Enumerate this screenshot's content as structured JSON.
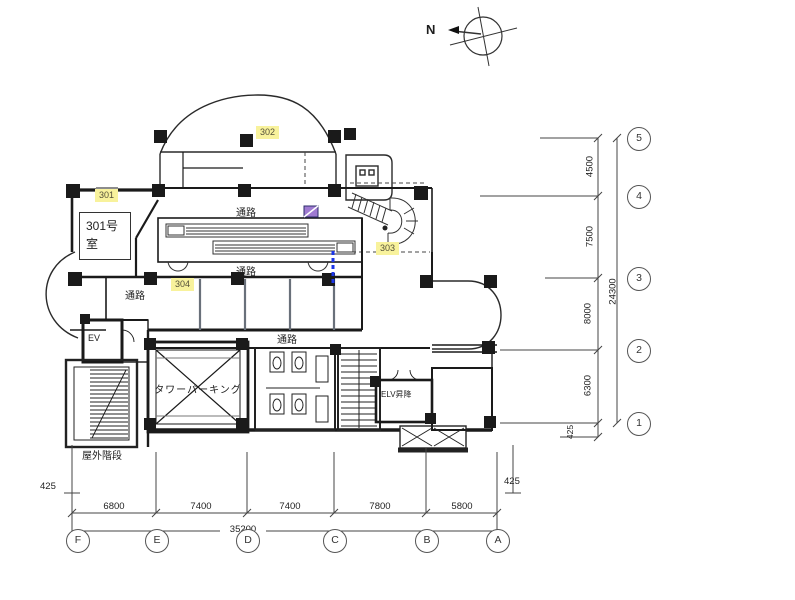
{
  "compass": {
    "north_label": "N"
  },
  "rooms": {
    "room301_label": "301号室",
    "badge301": "301",
    "badge302": "302",
    "badge303": "303",
    "badge304": "304",
    "passage": "通路",
    "tower_parking": "タワーパーキング",
    "elevator": "EV",
    "elv_shaft": "ELV昇降",
    "outdoor_stairs": "屋外階段"
  },
  "grid": {
    "row_ids": [
      "5",
      "4",
      "3",
      "2",
      "1"
    ],
    "col_ids": [
      "F",
      "E",
      "D",
      "C",
      "B",
      "A"
    ],
    "row_dims": [
      "4500",
      "7500",
      "8000",
      "6300"
    ],
    "row_total": "24300",
    "row_offset": "425",
    "col_dims": [
      "6800",
      "7400",
      "7400",
      "7800",
      "5800"
    ],
    "col_total": "35200",
    "col_offset_left": "425",
    "col_offset_right": "425"
  },
  "colors": {
    "highlight_yellow": "#f8f29c",
    "accent_blue": "#1b35e8",
    "accent_purple": "#9f7ad1",
    "wall_black": "#1a1a1a",
    "partition_gray": "#69707a"
  }
}
